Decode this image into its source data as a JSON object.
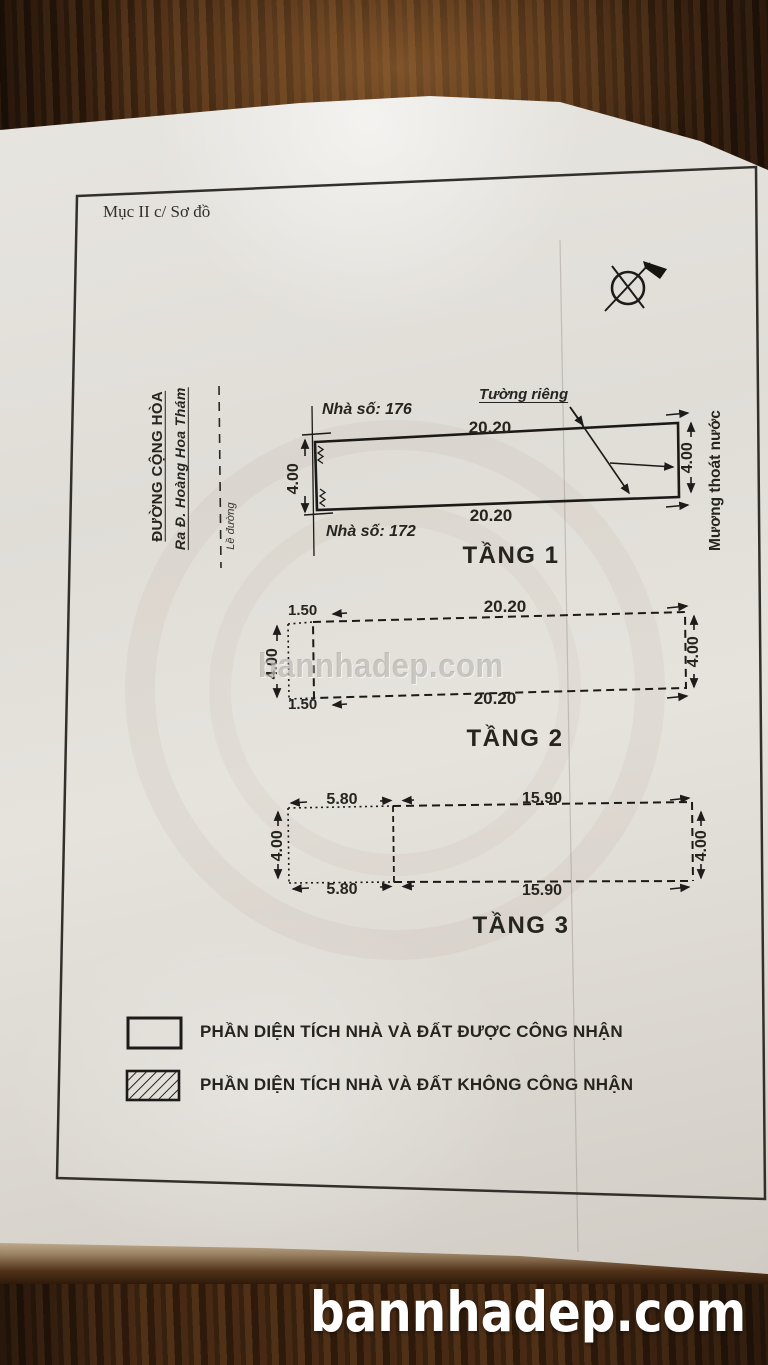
{
  "photo": {
    "section_label": "Mục II c/ Sơ đồ",
    "watermark_text": "bannhadep.com",
    "banner_text": "bannhadep.com"
  },
  "street": {
    "name": "ĐƯỜNG CỘNG HÒA",
    "direction": "Ra Đ. Hoàng Hoa Thám",
    "curb_label": "Lề đường"
  },
  "floors": [
    {
      "title": "TẦNG 1",
      "house_number_top": "Nhà số: 176",
      "house_number_bottom": "Nhà số: 172",
      "width_top": "20.20",
      "width_bottom": "20.20",
      "depth_left": "4.00",
      "depth_right": "4.00",
      "wall_note": "Tường riêng",
      "drain_note": "Mương thoát nước"
    },
    {
      "title": "TẦNG 2",
      "offset_top": "1.50",
      "offset_bottom": "1.50",
      "width_top": "20.20",
      "width_bottom": "20.20",
      "depth_left": "4.00",
      "depth_right": "4.00"
    },
    {
      "title": "TẦNG 3",
      "front_width_top": "5.80",
      "front_width_bottom": "5.80",
      "rear_width_top": "15.90",
      "rear_width_bottom": "15.90",
      "depth_left": "4.00",
      "depth_right": "4.00"
    }
  ],
  "legend": {
    "recognized": "PHẦN DIỆN TÍCH  NHÀ VÀ ĐẤT ĐƯỢC CÔNG NHẬN",
    "not_recognized": "PHẦN DIỆN TÍCH  NHÀ VÀ ĐẤT KHÔNG CÔNG NHẬN"
  },
  "icons": {
    "compass": "north-arrow-compass"
  },
  "colors": {
    "ink": "#24221f",
    "paper": "#e6e3dd",
    "wood": "#35200e",
    "banner_text": "#ffffff"
  }
}
